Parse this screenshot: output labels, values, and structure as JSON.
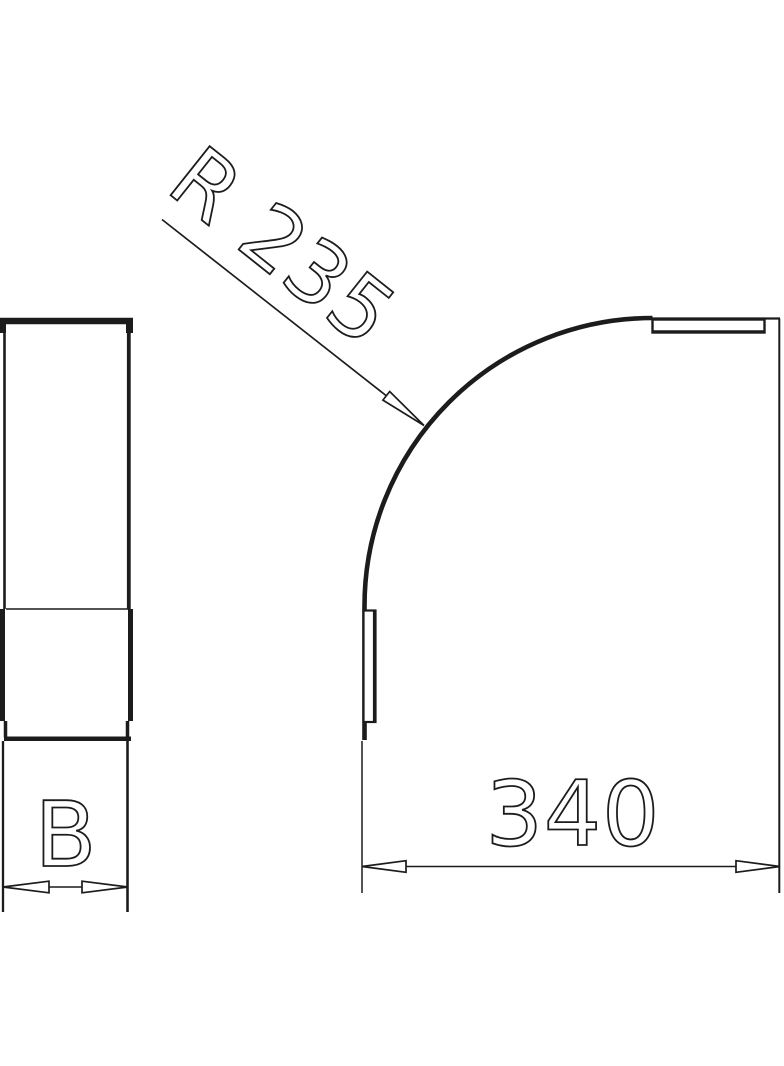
{
  "drawing": {
    "radius_label": "R 235",
    "length_label": "340",
    "width_label": "B",
    "colors": {
      "ink": "#1c1c1c",
      "background": "#ffffff"
    }
  }
}
